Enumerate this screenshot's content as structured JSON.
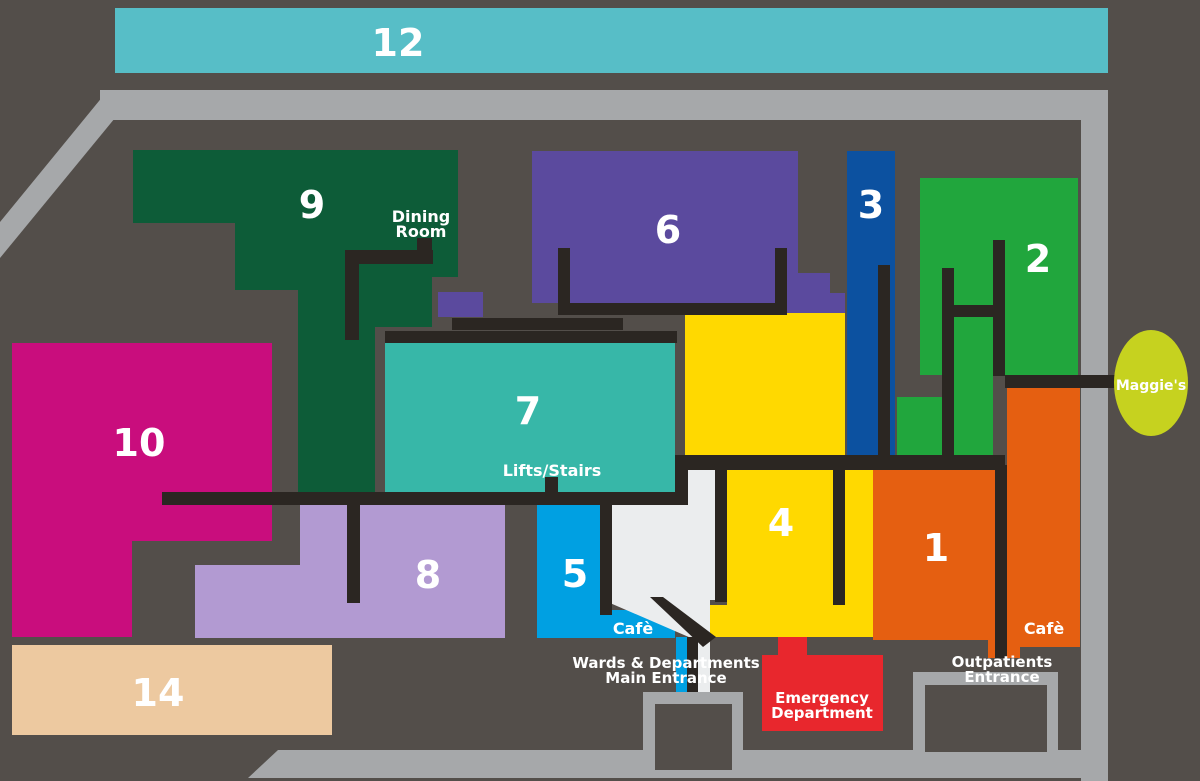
{
  "colors": {
    "background": "#534e4a",
    "road": "#a6a8aa",
    "corridor": "#2b2622",
    "label_text": "#ffffff",
    "block_12": "#57bec7",
    "block_9": "#0d5c38",
    "block_6": "#5b4a9e",
    "block_3": "#0c51a0",
    "block_2": "#21a63d",
    "block_7": "#37b7a8",
    "block_10": "#c90d7d",
    "block_8": "#b29ad2",
    "block_5": "#00a0e2",
    "block_4": "#ffd900",
    "block_1": "#e55f11",
    "block_14": "#edc9a0",
    "emergency": "#e8272d",
    "entrance_hall": "#ebedee",
    "maggies": "#c6d21f"
  },
  "blocks": {
    "b12": {
      "number": "12"
    },
    "b9": {
      "number": "9"
    },
    "b6": {
      "number": "6"
    },
    "b3": {
      "number": "3"
    },
    "b2": {
      "number": "2"
    },
    "b10": {
      "number": "10"
    },
    "b7": {
      "number": "7"
    },
    "b8": {
      "number": "8"
    },
    "b5": {
      "number": "5"
    },
    "b4": {
      "number": "4"
    },
    "b1": {
      "number": "1"
    },
    "b14": {
      "number": "14"
    }
  },
  "labels": {
    "dining_room_line1": "Dining",
    "dining_room_line2": "Room",
    "lifts_stairs": "Lifts/Stairs",
    "cafe_block5": "Cafè",
    "cafe_block1": "Cafè",
    "main_entrance_line1": "Wards & Departments",
    "main_entrance_line2": "Main Entrance",
    "emergency_line1": "Emergency",
    "emergency_line2": "Department",
    "outpatients_line1": "Outpatients",
    "outpatients_line2": "Entrance",
    "maggies": "Maggie's"
  }
}
